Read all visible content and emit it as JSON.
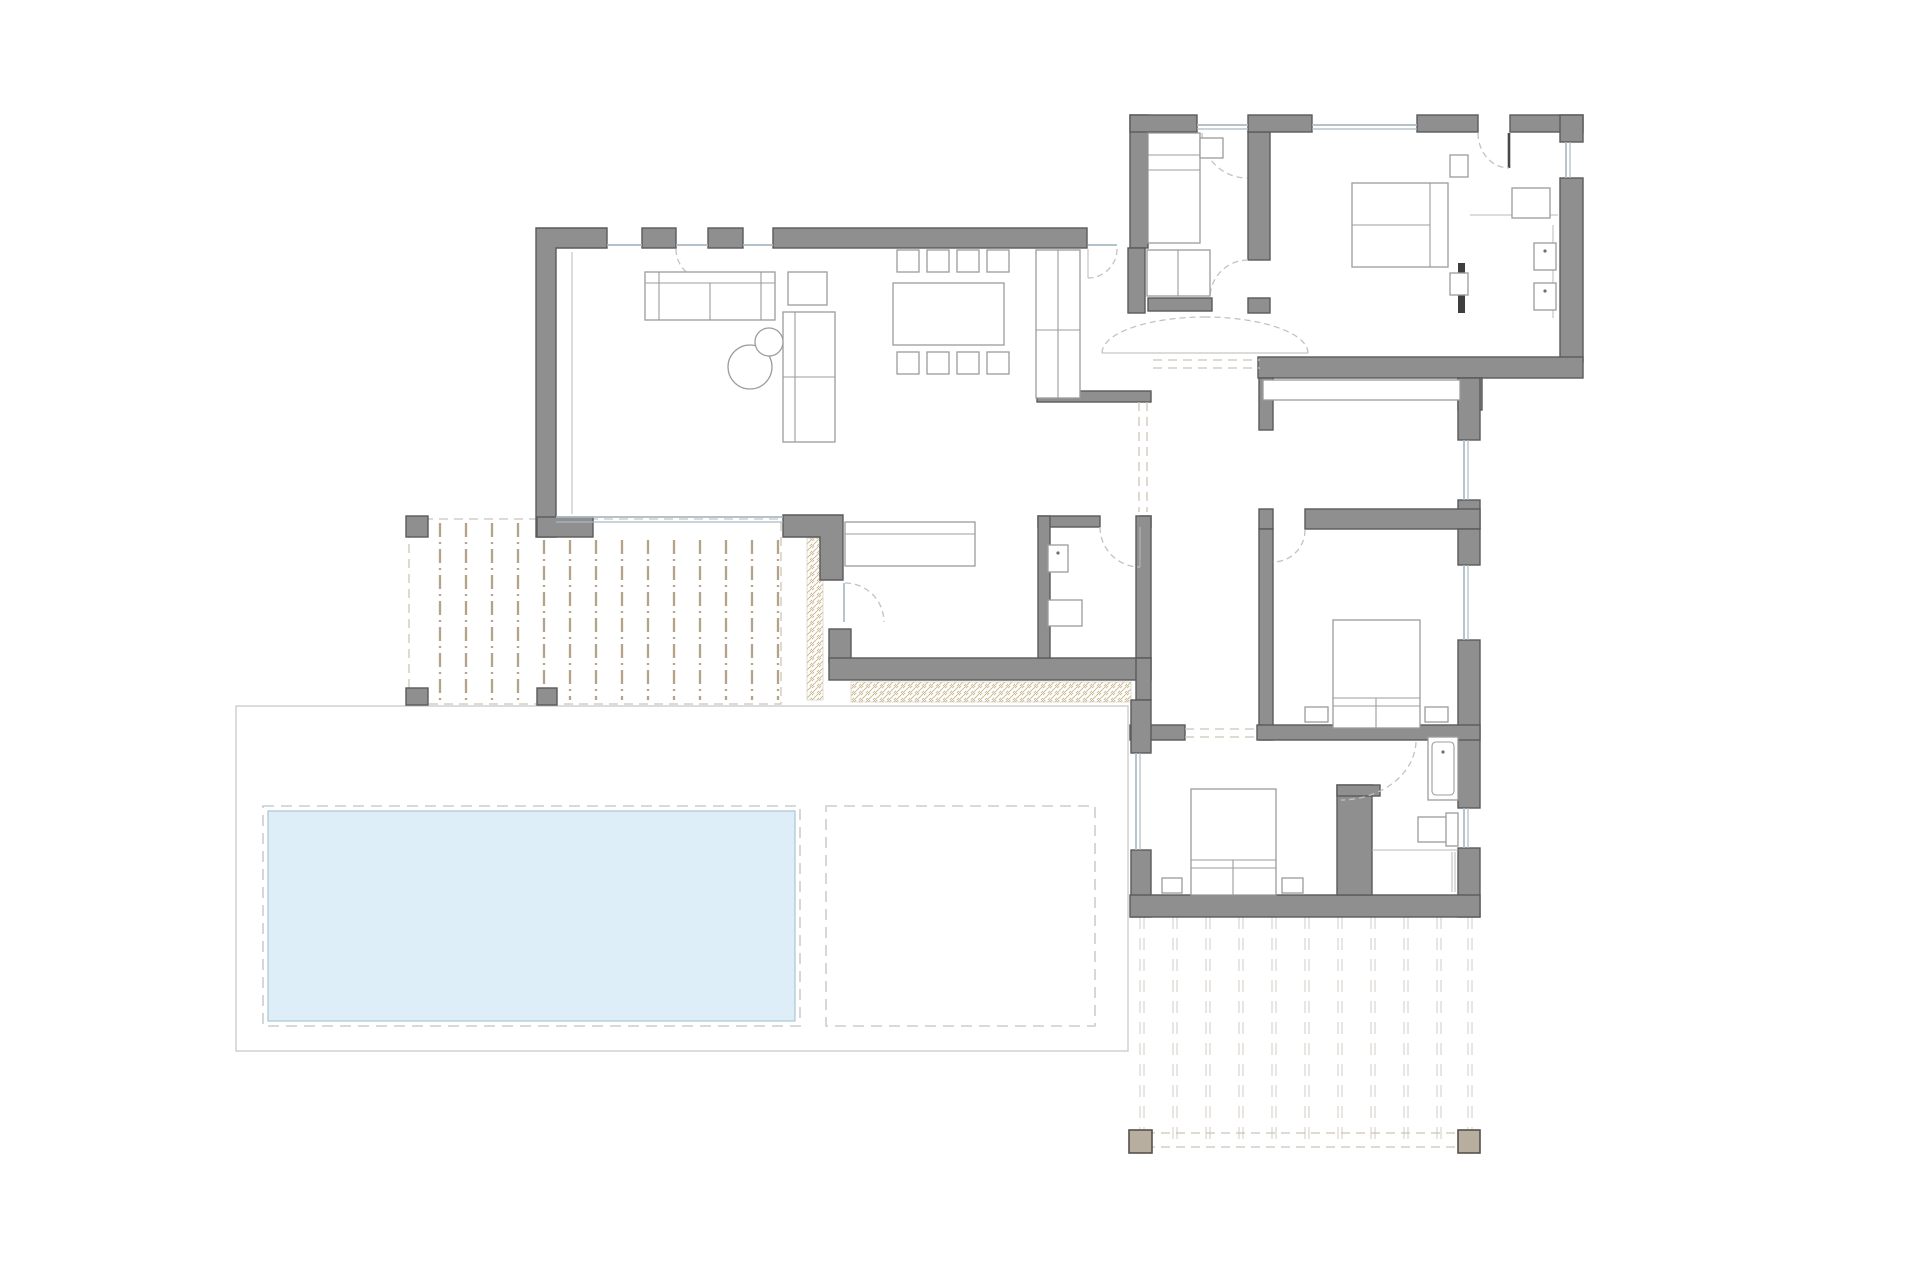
{
  "document": {
    "type": "architectural-floor-plan",
    "storey": "ground-floor",
    "text_labels": [],
    "background": "#ffffff"
  },
  "colors": {
    "background": "#ffffff",
    "wall": "#8f8f8f",
    "wall_edge": "#5a5a5a",
    "furniture": "#9c9c9c",
    "glass": "#a9bac4",
    "door_arc": "#c2c2c2",
    "deck_line": "#b2a389",
    "deck_border": "#ccc5b6",
    "hatch_tan": "#cdbc96",
    "south_deck_plank": "#d8d4ce",
    "south_deck_post": "#b7ae9f",
    "pool": "#ddeef8",
    "pool_edge": "#a9c6d4",
    "dash": "#c9ced1",
    "patio": "#c9c9c9"
  },
  "rooms": [
    {
      "name": "living-dining-room",
      "furniture": [
        "sofa",
        "side-table",
        "chaise-longue",
        "round-coffee-tables",
        "dining-table-8-chairs",
        "tall-cabinet"
      ]
    },
    {
      "name": "kitchen-extension",
      "furniture": [
        "kitchen-counter"
      ]
    },
    {
      "name": "wc",
      "furniture": [
        "washbasin",
        "bidet"
      ]
    },
    {
      "name": "entrance-hall",
      "furniture": [
        "closet",
        "double-swing-doors"
      ]
    },
    {
      "name": "bedroom-1",
      "furniture": [
        "single-bed",
        "bedside-table",
        "closet"
      ]
    },
    {
      "name": "master-bedroom",
      "furniture": [
        "double-bed",
        "two-nightstands",
        "wardrobe"
      ]
    },
    {
      "name": "dressing-ensuite",
      "furniture": [
        "two-washbasins",
        "shelf",
        "counter"
      ]
    },
    {
      "name": "corridor",
      "furniture": [
        "built-in-closet"
      ]
    },
    {
      "name": "bedroom-2",
      "furniture": [
        "double-bed",
        "two-nightstands"
      ]
    },
    {
      "name": "bedroom-3",
      "furniture": [
        "double-bed",
        "two-nightstands"
      ]
    },
    {
      "name": "bathroom",
      "furniture": [
        "shower",
        "toilet",
        "towel-rail"
      ]
    }
  ],
  "outdoor": [
    {
      "name": "covered-west-terrace",
      "features": [
        "timber-deck-boards",
        "three-posts",
        "gravel-edge-strips"
      ]
    },
    {
      "name": "pool-terrace",
      "features": [
        "paved-surround",
        "swimming-pool",
        "future-extension-dashed-area"
      ]
    },
    {
      "name": "south-deck",
      "features": [
        "timber-deck-boards",
        "two-timber-posts",
        "dashed-edge"
      ]
    }
  ],
  "counts": {
    "bedrooms": 4,
    "bathrooms": 3,
    "beds": 4,
    "dining_chairs": 8,
    "deck_posts": 5
  }
}
